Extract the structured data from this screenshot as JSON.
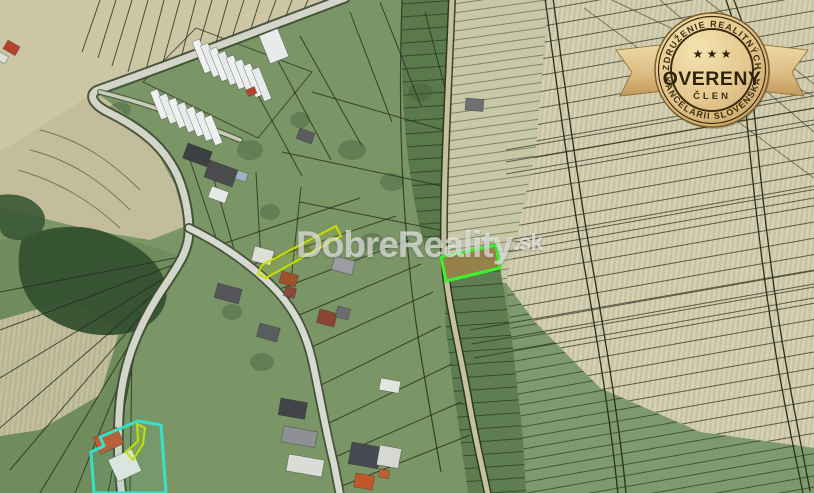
{
  "watermark": {
    "brand": "DobreReality",
    "tld": ".sk"
  },
  "badge": {
    "arc_top": "ZDRUŽENIE REALITNÝCH",
    "title": "OVERENÝ",
    "subtitle": "ČLEN",
    "arc_bottom": "KANCELÁRIÍ SLOVENSKA",
    "stars": "★ ★ ★"
  },
  "map": {
    "kind": "aerial-cadastral-map",
    "highlighted_parcel_color": "#3df22c",
    "secondary_parcel_color": "#38e0c6",
    "strip_parcel_color": "#c8e000",
    "parcel_line_color": "#262c1c"
  }
}
